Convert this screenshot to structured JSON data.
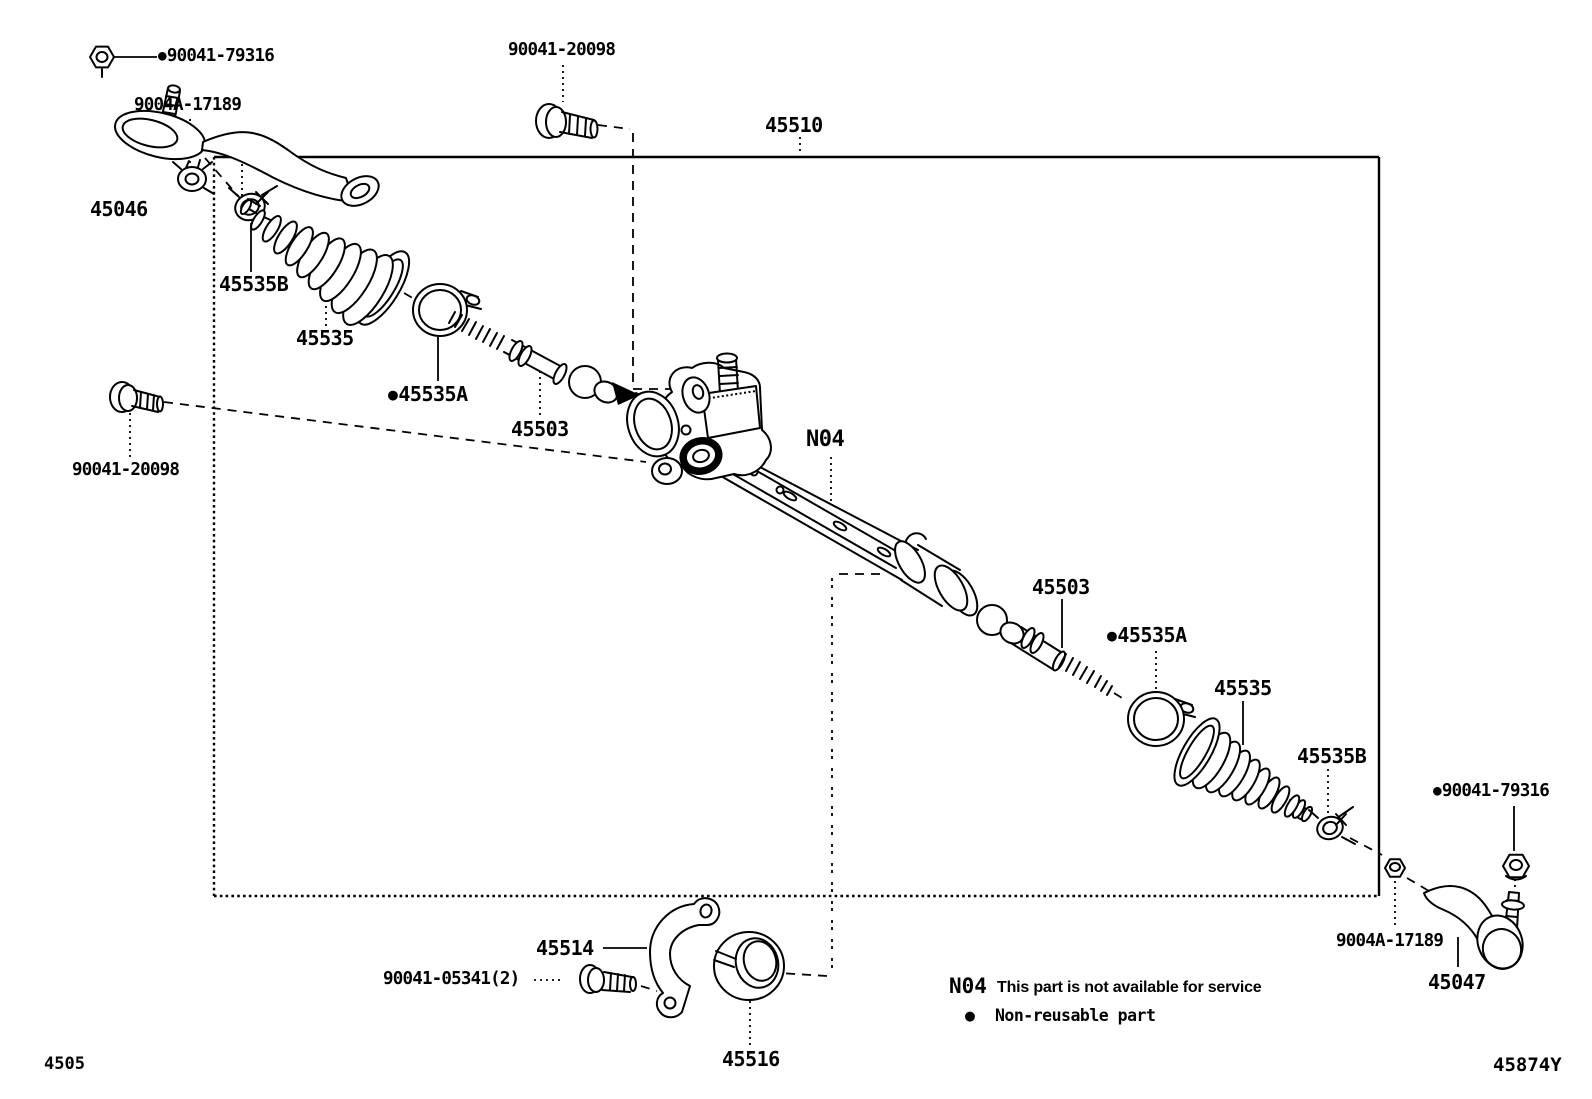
{
  "colors": {
    "ink": "#000000",
    "background": "#ffffff"
  },
  "callouts": {
    "nut_left": {
      "bullet": "●",
      "code": "90041-79316"
    },
    "lock_nut_left": {
      "code": "9004A-17189"
    },
    "tie_rod_end_left": {
      "code": "45046"
    },
    "bolt_top": {
      "code": "90041-20098"
    },
    "gear_assembly": {
      "code": "45510"
    },
    "boot_clamp_left": {
      "code": "45535B"
    },
    "boot_left": {
      "code": "45535"
    },
    "boot_clip_left": {
      "bullet": "●",
      "code": "45535A"
    },
    "inner_rod_left": {
      "code": "45503"
    },
    "bolt_left": {
      "code": "90041-20098"
    },
    "rack_marker": {
      "code": "N04"
    },
    "inner_rod_right": {
      "code": "45503"
    },
    "boot_clip_right": {
      "bullet": "●",
      "code": "45535A"
    },
    "boot_right": {
      "code": "45535"
    },
    "boot_clamp_right": {
      "code": "45535B"
    },
    "nut_right": {
      "bullet": "●",
      "code": "90041-79316"
    },
    "lock_nut_right": {
      "code": "9004A-17189"
    },
    "tie_rod_end_right": {
      "code": "45047"
    },
    "bracket": {
      "code": "45514"
    },
    "bracket_bolt": {
      "code": "90041-05341(2)"
    },
    "bushing": {
      "code": "45516"
    }
  },
  "legend": {
    "n04_code": "N04",
    "n04_text": "This part is not available for service",
    "bullet": "●",
    "bullet_text": "Non-reusable part"
  },
  "footer": {
    "figure_code": "4505",
    "sheet_code": "45874Y"
  }
}
